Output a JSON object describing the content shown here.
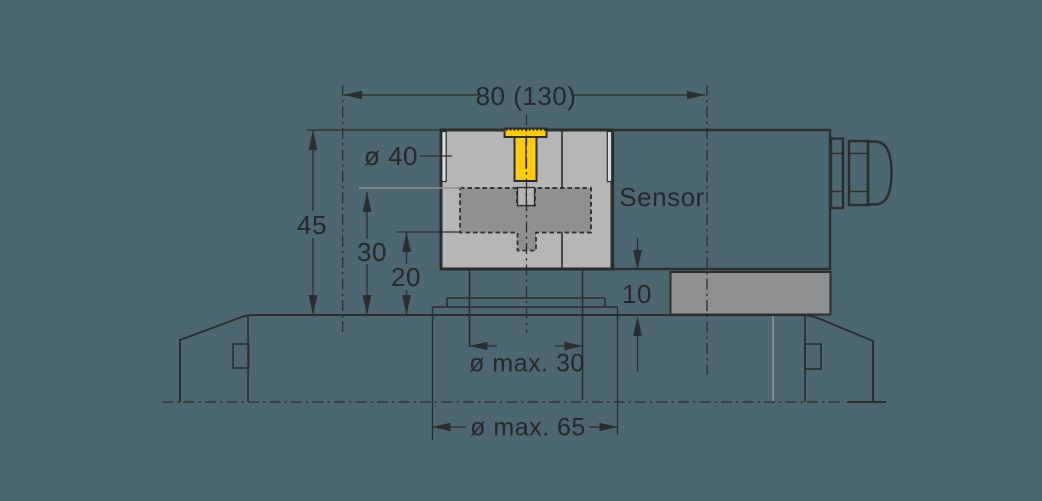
{
  "drawing": {
    "type": "technical-dimension-drawing",
    "subject": "Sensor measuring head mounted over machine bed"
  },
  "labels": {
    "width": "80 (130)",
    "diameter_top": "ø 40",
    "height_total": "45",
    "height_mid": "30",
    "height_low": "20",
    "sensor": "Sensor",
    "offset": "10",
    "diameter_spigot": "ø max. 30",
    "diameter_recess": "ø max. 65"
  },
  "colors": {
    "background": "#4C6771",
    "part_light_gray": "#B5B7B7",
    "part_mid_gray": "#8E9091",
    "highlight_yellow": "#FFCB05",
    "line_dark": "#2B2D2E",
    "line_gray": "#8F9496",
    "text": "#26282A"
  }
}
